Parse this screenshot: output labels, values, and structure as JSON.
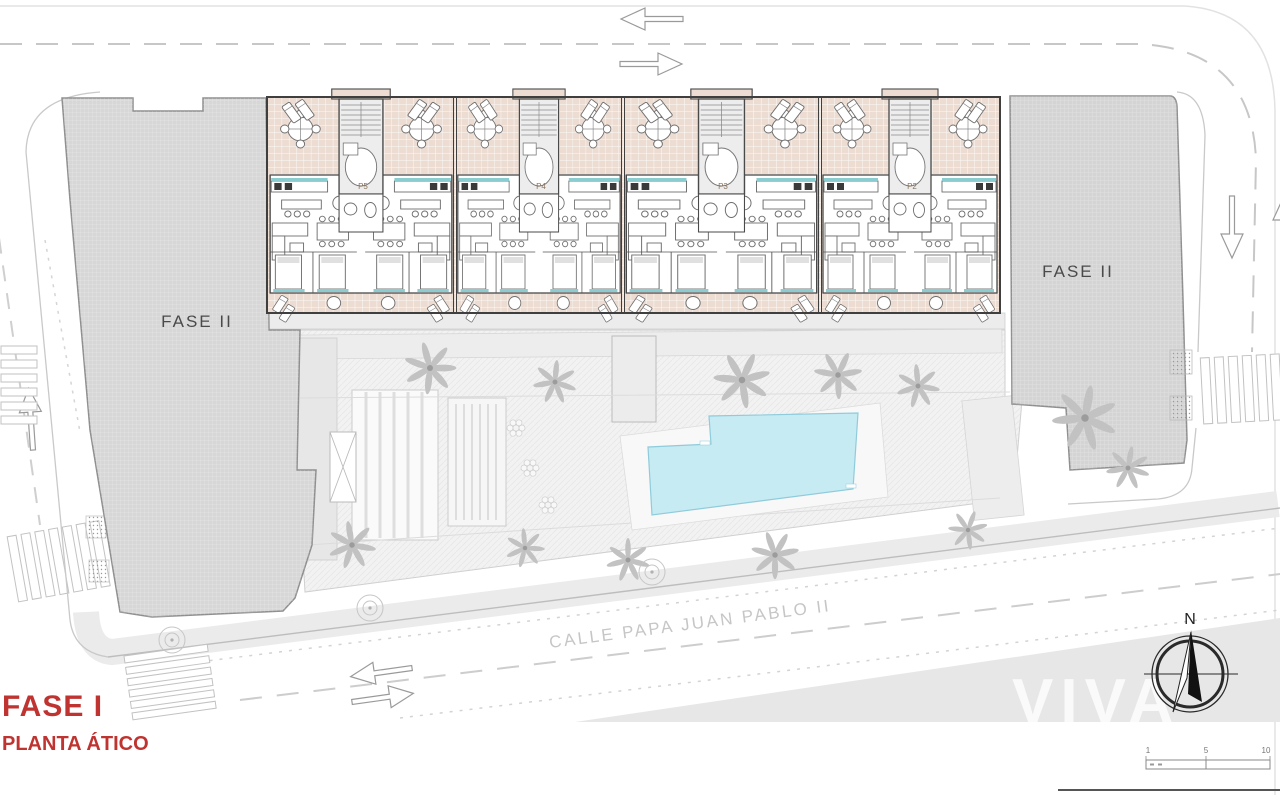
{
  "title_block": {
    "phase": "FASE I",
    "floor": "PLANTA ÁTICO"
  },
  "labels": {
    "building_left": "FASE II",
    "building_right": "FASE II",
    "street": "CALLE PAPA JUAN PABLO II",
    "north": "N",
    "watermark": "VIVA"
  },
  "cores": [
    {
      "label": "P5"
    },
    {
      "label": "P4"
    },
    {
      "label": "P3"
    },
    {
      "label": "P2"
    }
  ],
  "scale_bar": {
    "ticks": [
      "1",
      "5",
      "10"
    ]
  },
  "colors": {
    "accent_red": "#bf3430",
    "terrace": "#ecdcd2",
    "pool": "#c6ebf3",
    "building_gray": "#d7d7d7",
    "teal_accent": "#8bccd1",
    "wall": "#3f3f3f"
  }
}
